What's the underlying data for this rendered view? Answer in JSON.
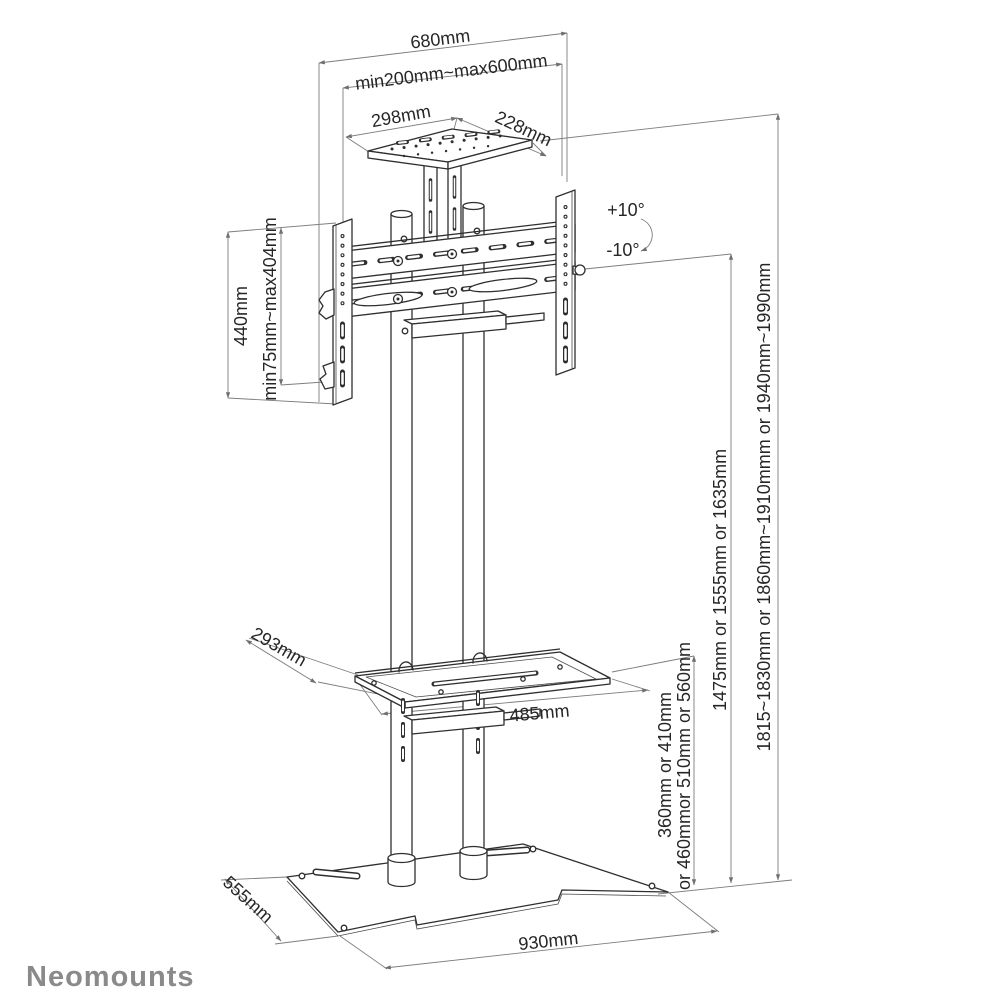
{
  "brand": {
    "logo_text": "Neomounts",
    "logo_color": "#8a8a8a"
  },
  "dimensions": {
    "overall_width": "680mm",
    "vesa_width_range": "min200mm~max600mm",
    "tray_width": "298mm",
    "tray_depth": "228mm",
    "tilt_up": "+10°",
    "tilt_down": "-10°",
    "bracket_height": "440mm",
    "vesa_height_range": "min75mm~max404mm",
    "shelf_depth": "293mm",
    "shelf_width": "485mm",
    "shelf_height_line1": "360mm or 410mm",
    "shelf_height_line2": "or 460mmor 510mm or 560mm",
    "pole_height": "1475mm or 1555mm or 1635mm",
    "total_height": "1815~1830mm or 1860mm~1910mmm or 1940mm~1990mm",
    "base_depth": "555mm",
    "base_width": "930mm"
  },
  "colors": {
    "structure_line": "#2f2f2f",
    "dimension_line": "#7d7d7d",
    "text": "#262626",
    "background": "#ffffff"
  }
}
